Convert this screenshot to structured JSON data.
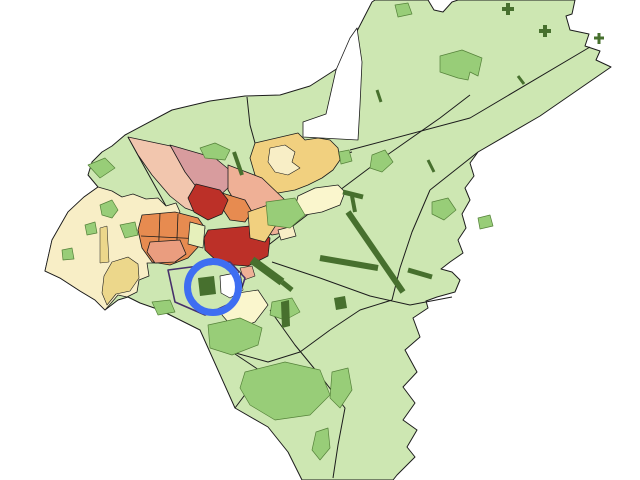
{
  "map": {
    "background": "#ffffff",
    "palette": {
      "lightGreen": "#cde7b2",
      "mediumGreen": "#98cd78",
      "mediumGreenBorder": "#55823a",
      "darkGreen": "#47702e",
      "cream": "#f8eec6",
      "yellow": "#ecd78b",
      "tan": "#f1d07f",
      "paleYellow": "#faf6cd",
      "lime": "#e6f0bb",
      "salmonLight": "#f2c6ae",
      "salmon": "#efb096",
      "salmonDeep": "#ea9d7f",
      "mauve": "#d89c9e",
      "orange": "#e78b50",
      "red": "#bc3028",
      "white": "#ffffff",
      "outline": "#1c1c1c",
      "purple": "#46306b",
      "highlightBlue": "#3e6ef2"
    },
    "shapes": [
      {
        "name": "city-base-silhouette",
        "type": "polygon",
        "fill": "lightGreen",
        "stroke": "outline",
        "strokeWidth": 1,
        "points": "125,135 172,110 210,101 245,96 280,95 310,86 338,68 372,2 375,0 428,0 434,10 443,12 452,2 458,0 575,0 572,14 566,16 570,30 589,34 585,46 600,51 596,60 611,67 540,116 478,152 470,163 474,176 465,188 470,200 462,214 466,228 458,240 463,253 450,262 441,269 452,272 460,280 455,292 437,297 426,301 428,308 413,318 420,337 405,350 417,372 403,387 415,403 403,420 417,430 407,447 415,457 397,475 393,480 302,480 288,452 268,427 235,408 200,330 160,310 140,303 128,297 118,300 105,310 95,300 80,291 60,278 45,271 52,240 68,212 84,197 98,187 88,175 92,162 102,152 112,146"
      },
      {
        "name": "white-notch-north",
        "type": "polygon",
        "fill": "white",
        "stroke": "outline",
        "strokeWidth": 0.8,
        "points": "336,70 350,38 357,28 362,62 360,105 358,140 303,137 303,122 326,114"
      },
      {
        "name": "boundary-ne-diagonal",
        "type": "polyline",
        "stroke": "outline",
        "strokeWidth": 1,
        "points": "590,47 470,118 350,150"
      },
      {
        "name": "boundary-east",
        "type": "polyline",
        "stroke": "outline",
        "strokeWidth": 1,
        "points": "430,190 412,232 400,268 392,300"
      },
      {
        "name": "boundary-ne-short",
        "type": "polyline",
        "stroke": "outline",
        "strokeWidth": 1,
        "points": "478,152 430,190"
      },
      {
        "name": "boundary-south-1",
        "type": "polyline",
        "stroke": "outline",
        "strokeWidth": 1,
        "points": "232,352 268,362 300,352 330,330"
      },
      {
        "name": "boundary-south-2",
        "type": "polyline",
        "stroke": "outline",
        "strokeWidth": 1,
        "points": "330,330 360,310 392,300"
      },
      {
        "name": "boundary-nw",
        "type": "polyline",
        "stroke": "outline",
        "strokeWidth": 1,
        "points": "128,137 145,168 160,195 166,206"
      },
      {
        "name": "boundary-north-small",
        "type": "polyline",
        "stroke": "outline",
        "strokeWidth": 1,
        "points": "247,97 250,125 255,143"
      },
      {
        "name": "road-northeast",
        "type": "polyline",
        "stroke": "outline",
        "strokeWidth": 1,
        "points": "262,250 320,205 380,160 440,118 470,95"
      },
      {
        "name": "road-east",
        "type": "polyline",
        "stroke": "outline",
        "strokeWidth": 1,
        "points": "272,262 320,278 370,296 410,305 452,297"
      },
      {
        "name": "road-south",
        "type": "polyline",
        "stroke": "outline",
        "strokeWidth": 1,
        "points": "270,310 295,345 322,378 345,408 338,445 333,478"
      },
      {
        "name": "road-center-ne",
        "type": "polyline",
        "stroke": "outline",
        "strokeWidth": 1,
        "points": "352,152 318,160 290,172 270,200 262,250"
      },
      {
        "name": "boundary-sw",
        "type": "polyline",
        "stroke": "outline",
        "strokeWidth": 1,
        "points": "235,408 262,372 232,352"
      },
      {
        "name": "district-cream-west",
        "type": "polygon",
        "fill": "cream",
        "stroke": "outline",
        "strokeWidth": 0.8,
        "points": "98,187 112,191 122,197 133,194 146,199 158,198 166,206 176,203 180,212 172,224 177,235 168,247 160,243 153,253 157,263 147,263 149,276 139,280 137,292 127,297 118,295 112,302 105,310 95,300 80,291 60,278 45,271 52,240 68,212 84,197"
      },
      {
        "name": "patch-yellow-in-cream",
        "type": "polygon",
        "fill": "yellow",
        "stroke": "outline",
        "strokeWidth": 0.6,
        "points": "112,262 128,257 138,264 139,278 130,291 116,294 107,305 102,293 104,276"
      },
      {
        "name": "patch-yellow-strip",
        "type": "polygon",
        "fill": "yellow",
        "stroke": "outline",
        "strokeWidth": 0.5,
        "points": "100,228 107,226 109,262 100,263"
      },
      {
        "name": "district-tan-northeast",
        "type": "polygon",
        "fill": "tan",
        "stroke": "outline",
        "strokeWidth": 0.8,
        "points": "255,143 298,133 305,140 318,138 330,140 338,148 340,160 333,170 322,178 308,185 295,190 278,193 265,188 255,175 250,158"
      },
      {
        "name": "patch-cream-in-tan",
        "type": "polygon",
        "fill": "cream",
        "stroke": "outline",
        "strokeWidth": 0.6,
        "points": "270,148 285,145 295,152 292,162 300,168 288,175 275,172 268,162"
      },
      {
        "name": "district-paleyellow-east",
        "type": "polygon",
        "fill": "paleYellow",
        "stroke": "outline",
        "strokeWidth": 0.8,
        "points": "298,196 315,188 338,185 345,192 340,205 322,212 305,215 295,208"
      },
      {
        "name": "district-salmon-wedge-west",
        "type": "polygon",
        "fill": "salmonLight",
        "stroke": "outline",
        "strokeWidth": 0.8,
        "points": "128,137 180,148 212,160 225,172 220,188 208,200 196,212 185,208 170,196 152,175 138,155"
      },
      {
        "name": "district-mauve-wedge",
        "type": "polygon",
        "fill": "mauve",
        "stroke": "outline",
        "strokeWidth": 0.8,
        "points": "170,145 215,158 232,172 228,188 215,200 200,192 185,172"
      },
      {
        "name": "district-salmon-wedge-east",
        "type": "polygon",
        "fill": "salmon",
        "stroke": "outline",
        "strokeWidth": 0.8,
        "points": "228,165 262,178 285,200 295,218 288,232 272,235 255,225 240,210 228,190"
      },
      {
        "name": "district-orange-blocks",
        "type": "polygon",
        "fill": "orange",
        "stroke": "outline",
        "strokeWidth": 0.8,
        "points": "142,215 175,212 198,218 205,228 200,245 188,258 170,265 152,262 142,248 138,230"
      },
      {
        "name": "orange-block-line-1",
        "type": "polyline",
        "stroke": "outline",
        "strokeWidth": 0.8,
        "points": "160,213 158,262"
      },
      {
        "name": "orange-block-line-2",
        "type": "polyline",
        "stroke": "outline",
        "strokeWidth": 0.8,
        "points": "178,214 176,263"
      },
      {
        "name": "orange-block-line-3",
        "type": "polyline",
        "stroke": "outline",
        "strokeWidth": 0.8,
        "points": "141,236 203,239"
      },
      {
        "name": "district-orange-wedge",
        "type": "polygon",
        "fill": "orange",
        "stroke": "outline",
        "strokeWidth": 0.8,
        "points": "222,193 245,200 252,212 245,222 230,220 220,205"
      },
      {
        "name": "district-red-wedge",
        "type": "polygon",
        "fill": "red",
        "stroke": "outline",
        "strokeWidth": 0.8,
        "points": "196,184 220,190 228,200 222,214 208,220 194,212 188,198"
      },
      {
        "name": "district-salmon-block-sw",
        "type": "polygon",
        "fill": "salmonDeep",
        "stroke": "outline",
        "strokeWidth": 0.8,
        "points": "150,242 180,240 186,254 175,262 155,263 147,252"
      },
      {
        "name": "district-red-central",
        "type": "polygon",
        "fill": "red",
        "stroke": "outline",
        "strokeWidth": 0.8,
        "points": "208,230 250,226 270,238 268,256 248,266 220,264 205,250 204,238"
      },
      {
        "name": "district-lime-west",
        "type": "polygon",
        "fill": "lime",
        "stroke": "outline",
        "strokeWidth": 0.7,
        "points": "190,222 205,226 203,248 188,244"
      },
      {
        "name": "district-tan-band-se",
        "type": "polygon",
        "fill": "tan",
        "stroke": "outline",
        "strokeWidth": 0.7,
        "points": "248,212 268,205 278,222 265,242 250,238"
      },
      {
        "name": "block-cream-small",
        "type": "polygon",
        "fill": "cream",
        "stroke": "outline",
        "strokeWidth": 0.7,
        "points": "278,230 293,226 296,236 281,240"
      },
      {
        "name": "patch-salmon-small",
        "type": "polygon",
        "fill": "salmon",
        "stroke": "outline",
        "strokeWidth": 0.6,
        "points": "240,268 252,266 255,276 244,280"
      },
      {
        "name": "district-cream-south-of-circle",
        "type": "polygon",
        "fill": "paleYellow",
        "stroke": "outline",
        "strokeWidth": 0.7,
        "points": "225,295 258,290 268,305 255,322 235,330 222,315"
      },
      {
        "name": "district-selected-purple",
        "type": "polygon",
        "fill": "lightGreen",
        "stroke": "purple",
        "strokeWidth": 1.6,
        "points": "168,270 230,262 245,278 238,300 205,315 175,302"
      },
      {
        "name": "district-white-center",
        "type": "polygon",
        "fill": "white",
        "stroke": "outline",
        "strokeWidth": 0.7,
        "points": "220,276 240,272 243,290 230,298 221,293"
      },
      {
        "name": "green-patch-nw-1",
        "type": "polygon",
        "fill": "mediumGreen",
        "stroke": "mediumGreenBorder",
        "strokeWidth": 0.7,
        "points": "100,205 112,200 118,210 112,218 102,215"
      },
      {
        "name": "green-patch-nw-2",
        "type": "polygon",
        "fill": "mediumGreen",
        "stroke": "mediumGreenBorder",
        "strokeWidth": 0.7,
        "points": "120,225 135,222 138,235 125,238"
      },
      {
        "name": "green-patch-nw-3",
        "type": "polygon",
        "fill": "mediumGreen",
        "stroke": "mediumGreenBorder",
        "strokeWidth": 0.7,
        "points": "85,225 95,222 97,233 87,235"
      },
      {
        "name": "green-patch-nw-4",
        "type": "polygon",
        "fill": "mediumGreen",
        "stroke": "mediumGreenBorder",
        "strokeWidth": 0.7,
        "points": "62,250 72,248 74,259 63,260"
      },
      {
        "name": "green-patch-top",
        "type": "polygon",
        "fill": "mediumGreen",
        "stroke": "mediumGreenBorder",
        "strokeWidth": 0.7,
        "points": "200,148 215,143 230,150 225,160 205,158"
      },
      {
        "name": "green-patch-west",
        "type": "polygon",
        "fill": "mediumGreen",
        "stroke": "mediumGreenBorder",
        "strokeWidth": 0.7,
        "points": "88,165 105,158 115,168 100,178"
      },
      {
        "name": "green-patch-ball-1",
        "type": "polygon",
        "fill": "mediumGreen",
        "stroke": "mediumGreenBorder",
        "strokeWidth": 0.7,
        "points": "372,155 385,150 393,162 382,172 370,168"
      },
      {
        "name": "green-patch-ball-2",
        "type": "polygon",
        "fill": "mediumGreen",
        "stroke": "mediumGreenBorder",
        "strokeWidth": 0.7,
        "points": "432,202 448,198 456,210 444,220 432,214"
      },
      {
        "name": "green-patch-mid",
        "type": "polygon",
        "fill": "mediumGreen",
        "stroke": "mediumGreenBorder",
        "strokeWidth": 0.7,
        "points": "266,202 295,198 305,215 290,228 268,225"
      },
      {
        "name": "green-patch-village-ne",
        "type": "polygon",
        "fill": "mediumGreen",
        "stroke": "mediumGreenBorder",
        "strokeWidth": 0.7,
        "points": "440,56 462,50 482,58 478,76 470,72 468,80 458,78 440,72"
      },
      {
        "name": "green-patch-top-small",
        "type": "polygon",
        "fill": "mediumGreen",
        "stroke": "mediumGreenBorder",
        "strokeWidth": 0.7,
        "points": "395,5 408,3 412,14 398,17"
      },
      {
        "name": "green-patch-south-big",
        "type": "polygon",
        "fill": "mediumGreen",
        "stroke": "mediumGreenBorder",
        "strokeWidth": 0.7,
        "points": "245,372 285,362 320,370 330,395 310,415 275,420 250,405 240,388"
      },
      {
        "name": "green-patch-south-2",
        "type": "polygon",
        "fill": "mediumGreen",
        "stroke": "mediumGreenBorder",
        "strokeWidth": 0.7,
        "points": "332,372 348,368 352,390 340,408 330,398"
      },
      {
        "name": "green-patch-below-circle",
        "type": "polygon",
        "fill": "mediumGreen",
        "stroke": "mediumGreenBorder",
        "strokeWidth": 0.7,
        "points": "208,325 240,318 262,328 258,345 232,355 210,348"
      },
      {
        "name": "green-patch-se",
        "type": "polygon",
        "fill": "mediumGreen",
        "stroke": "mediumGreenBorder",
        "strokeWidth": 0.7,
        "points": "272,302 292,298 300,312 285,320 270,315"
      },
      {
        "name": "green-patch-sw",
        "type": "polygon",
        "fill": "mediumGreen",
        "stroke": "mediumGreenBorder",
        "strokeWidth": 0.7,
        "points": "152,302 170,300 175,312 158,315"
      },
      {
        "name": "green-patch-south-3",
        "type": "polygon",
        "fill": "mediumGreen",
        "stroke": "mediumGreenBorder",
        "strokeWidth": 0.7,
        "points": "316,432 328,428 330,448 320,460 312,450"
      },
      {
        "name": "green-patch-near-tan",
        "type": "polygon",
        "fill": "mediumGreen",
        "stroke": "mediumGreenBorder",
        "strokeWidth": 0.7,
        "points": "339,152 349,150 352,161 341,164"
      },
      {
        "name": "green-patch-right",
        "type": "polygon",
        "fill": "mediumGreen",
        "stroke": "mediumGreenBorder",
        "strokeWidth": 0.7,
        "points": "478,218 490,215 493,226 480,229"
      },
      {
        "name": "darkgreen-square-center",
        "type": "polygon",
        "fill": "darkGreen",
        "points": "198,278 214,276 216,294 200,296"
      },
      {
        "name": "darkgreen-rect-south",
        "type": "polygon",
        "fill": "darkGreen",
        "points": "281,302 289,300 290,326 282,328"
      },
      {
        "name": "darkgreen-blob-south",
        "type": "polygon",
        "fill": "darkGreen",
        "points": "334,298 345,296 347,308 336,310"
      },
      {
        "name": "darkgreen-band",
        "type": "polyline",
        "stroke": "darkGreen",
        "strokeWidth": 8,
        "points": "252,260 282,282"
      },
      {
        "name": "darkgreen-band-tail",
        "type": "polyline",
        "stroke": "darkGreen",
        "strokeWidth": 5,
        "points": "282,282 292,290"
      },
      {
        "name": "runway-main",
        "type": "polyline",
        "stroke": "darkGreen",
        "strokeWidth": 6,
        "points": "348,212 403,292"
      },
      {
        "name": "runway-cross-arm",
        "type": "polyline",
        "stroke": "darkGreen",
        "strokeWidth": 6,
        "points": "320,258 378,268"
      },
      {
        "name": "runway-arm-east",
        "type": "polyline",
        "stroke": "darkGreen",
        "strokeWidth": 5,
        "points": "408,270 432,277"
      },
      {
        "name": "runway-top-bar",
        "type": "polyline",
        "stroke": "darkGreen",
        "strokeWidth": 5,
        "points": "343,192 363,197"
      },
      {
        "name": "runway-top-stem",
        "type": "polyline",
        "stroke": "darkGreen",
        "strokeWidth": 4,
        "points": "352,196 355,212"
      },
      {
        "name": "darkgreen-sliver",
        "type": "polyline",
        "stroke": "darkGreen",
        "strokeWidth": 4,
        "points": "234,152 242,175"
      },
      {
        "name": "darkgreen-cross-1a",
        "type": "polyline",
        "stroke": "darkGreen",
        "strokeWidth": 4,
        "points": "502,9 514,9"
      },
      {
        "name": "darkgreen-cross-1b",
        "type": "polyline",
        "stroke": "darkGreen",
        "strokeWidth": 4,
        "points": "508,3 508,15"
      },
      {
        "name": "darkgreen-cross-2a",
        "type": "polyline",
        "stroke": "darkGreen",
        "strokeWidth": 4,
        "points": "539,31 551,31"
      },
      {
        "name": "darkgreen-cross-2b",
        "type": "polyline",
        "stroke": "darkGreen",
        "strokeWidth": 4,
        "points": "545,25 545,37"
      },
      {
        "name": "darkgreen-cross-3a",
        "type": "polyline",
        "stroke": "darkGreen",
        "strokeWidth": 3,
        "points": "594,38 604,38"
      },
      {
        "name": "darkgreen-cross-3b",
        "type": "polyline",
        "stroke": "darkGreen",
        "strokeWidth": 3,
        "points": "599,33 599,44"
      },
      {
        "name": "darkgreen-stick-1",
        "type": "polyline",
        "stroke": "darkGreen",
        "strokeWidth": 3,
        "points": "518,76 524,84"
      },
      {
        "name": "darkgreen-stick-2",
        "type": "polyline",
        "stroke": "darkGreen",
        "strokeWidth": 3,
        "points": "428,160 434,172"
      },
      {
        "name": "darkgreen-stick-3",
        "type": "polyline",
        "stroke": "darkGreen",
        "strokeWidth": 3,
        "points": "377,90 381,102"
      },
      {
        "name": "highlight-ring",
        "type": "circle",
        "cx": 213,
        "cy": 287,
        "r": 25.5,
        "fill": "none",
        "stroke": "highlightBlue",
        "strokeWidth": 7
      }
    ]
  }
}
